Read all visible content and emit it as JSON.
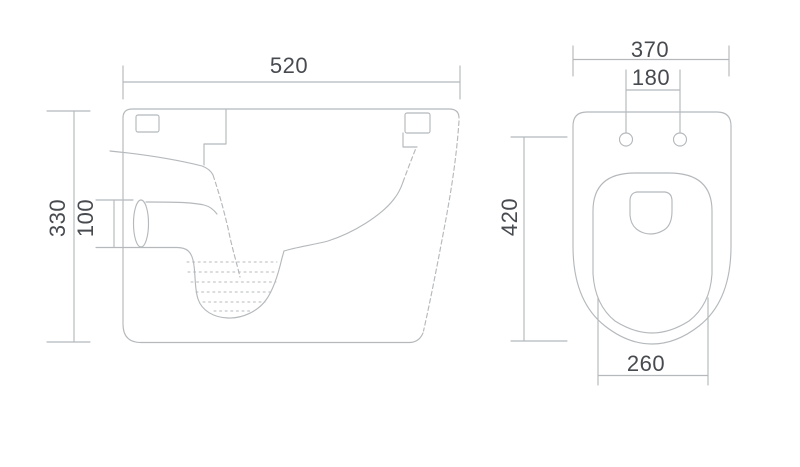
{
  "colors": {
    "line": "#b5b9bc",
    "text": "#474a4f",
    "background": "#ffffff"
  },
  "side_view": {
    "dim_width": "520",
    "dim_height": "330",
    "dim_outlet_diameter": "100"
  },
  "top_view": {
    "dim_width": "370",
    "dim_fixing_hole_spacing": "180",
    "dim_depth": "420",
    "dim_bowl_width": "260"
  }
}
